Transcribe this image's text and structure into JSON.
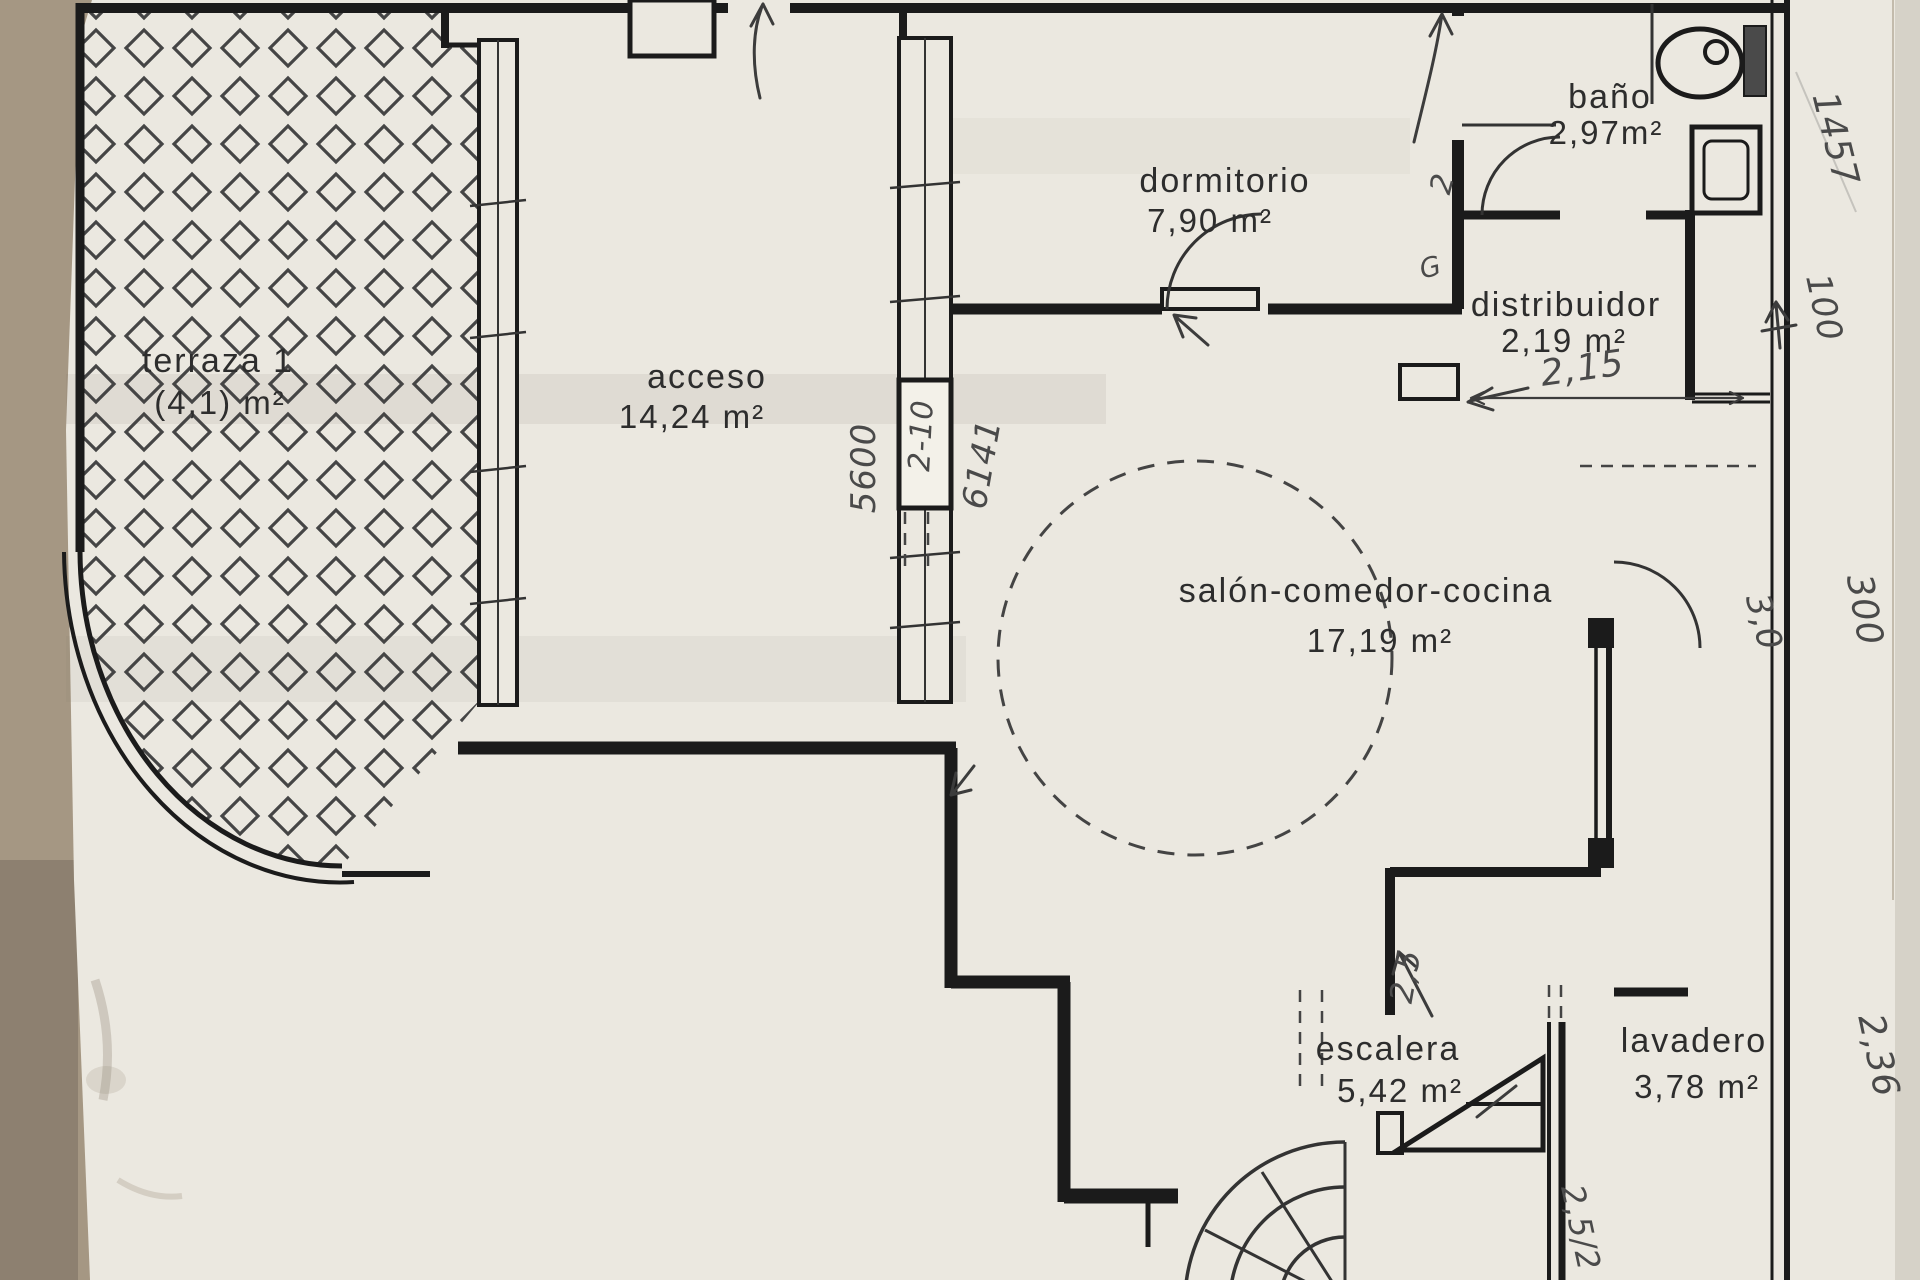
{
  "document": {
    "kind": "scanned floor plan",
    "language": "es"
  },
  "colors": {
    "background": "#a59783",
    "paper": "#ebe8e0",
    "ink": "#1b1b1b",
    "pencil": "#4a4a4a"
  },
  "rooms": [
    {
      "name": "terraza 1",
      "area": "(4,1) m²"
    },
    {
      "name": "acceso",
      "area": "14,24 m²"
    },
    {
      "name": "dormitorio",
      "area": "7,90 m²"
    },
    {
      "name": "baño",
      "area": "2,97m²"
    },
    {
      "name": "distribuidor",
      "area": "2,19 m²"
    },
    {
      "name": "salón-comedor-cocina",
      "area": "17,19 m²"
    },
    {
      "name": "escalera",
      "area": "5,42 m²"
    },
    {
      "name": "lavadero",
      "area": "3,78 m²"
    }
  ],
  "handwritten": {
    "dim_5600": "5600",
    "dim_2_10": "2-10",
    "dim_6141": "6141",
    "dim_2_15": "2,15",
    "mark_2": "2",
    "mark_g": "G",
    "dim_1457": "1457",
    "dim_100": "100",
    "dim_3_0": "3,0",
    "dim_300": "300",
    "dim_2_36": "2,36",
    "dim_2_5": "2,5",
    "dim_2_5_2": "2,5/2"
  }
}
